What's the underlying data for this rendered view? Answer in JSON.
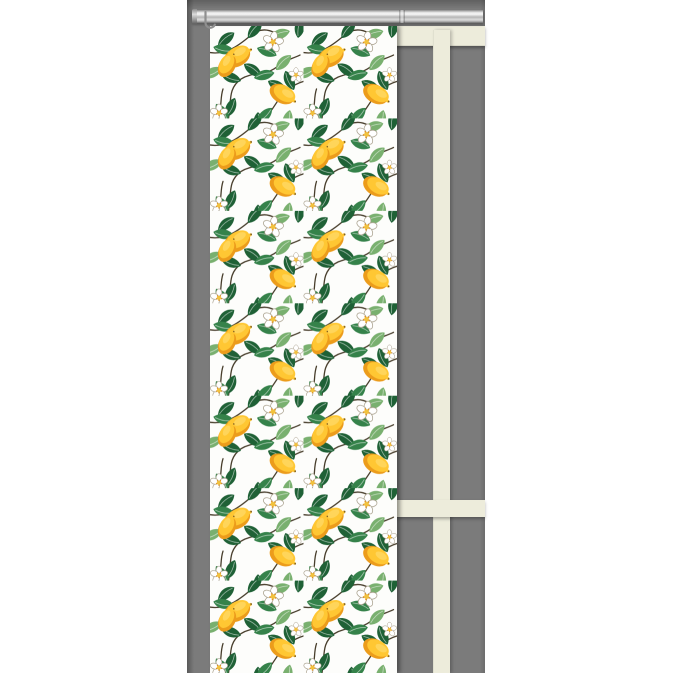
{
  "scene": {
    "type": "product-photo",
    "subject": "panel curtain with lemon, leaf and blossom pattern hanging from a silver rail in front of a grey wall with a cream window frame",
    "elements": {
      "wall": "grey-wall",
      "rail": "silver-curtain-rail",
      "hook": "curtain-glider-hook",
      "curtain": "lemon-pattern-panel-curtain",
      "window_top": "window-frame-top-beam",
      "window_mullion": "window-frame-mullion",
      "window_crossbar": "window-frame-crossbar"
    },
    "colors": {
      "page_bg": "#ffffff",
      "wall": "#7b7b7b",
      "frame": "#edecdb",
      "rod_mid": "#b5b5b5",
      "rod_dark": "#8a8a8a",
      "curtain_bg": "#fdfdfb",
      "lemon": "#ffc733",
      "lemon_shade": "#ec9c1b",
      "lemon_hi": "#ffe07a",
      "lemon_tip": "#7a5a22",
      "leaf_dark": "#1f6136",
      "leaf_mid": "#35824a",
      "leaf_light": "#79b06f",
      "branch": "#473d2b",
      "petal_line": "#a39a85",
      "flower_center": "#f2c23c",
      "flower_dot": "#df8f1f"
    }
  }
}
